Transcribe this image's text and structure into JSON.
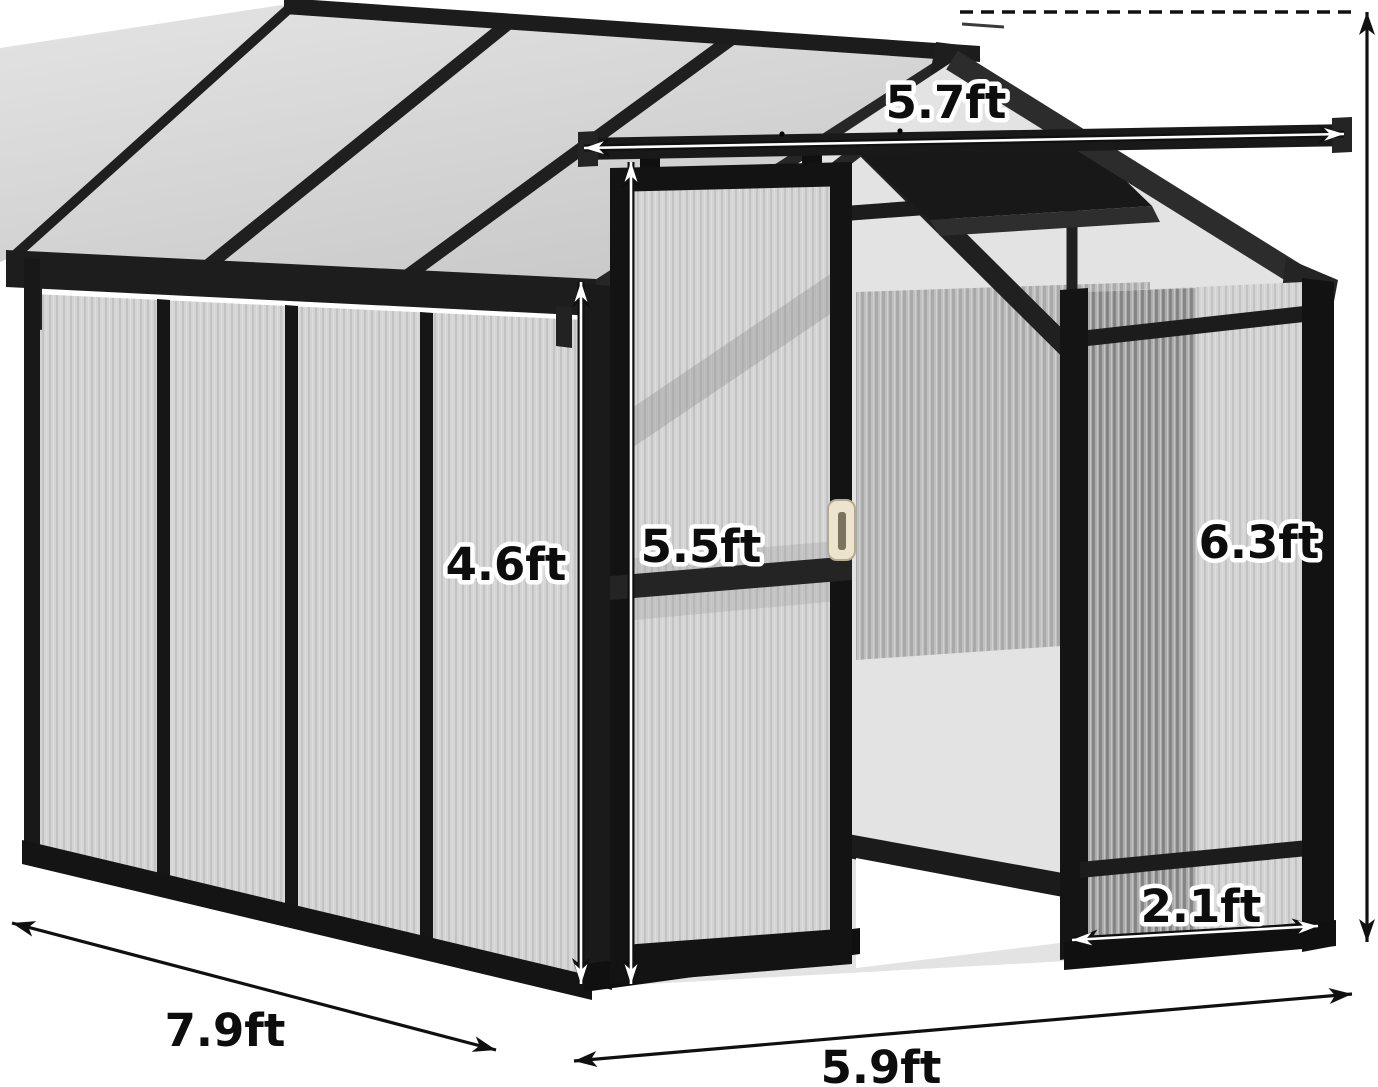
{
  "figure": {
    "kind": "product-dimension-diagram",
    "subject": "greenhouse with sliding door and sliding roof rail",
    "background": "#ffffff",
    "colors": {
      "frame": "#1a1a1a",
      "panel_glass": "#d4d4d4",
      "panel_rib": "#c0c0c0",
      "roof_glass_light": "#e2e2e2",
      "roof_glass_dark": "#cccccc",
      "interior_glass": "#e3e3e3",
      "door_handle": "#ece4cd",
      "dimension_line": "#101010",
      "label_text": "#0d0d0d",
      "label_outline": "#ffffff"
    },
    "dimensions": [
      {
        "id": "top-rail-length",
        "label": "5.7ft"
      },
      {
        "id": "side-wall-height",
        "label": "4.6ft"
      },
      {
        "id": "door-height",
        "label": "5.5ft"
      },
      {
        "id": "peak-height",
        "label": "6.3ft"
      },
      {
        "id": "front-panel-width",
        "label": "2.1ft"
      },
      {
        "id": "side-depth",
        "label": "7.9ft"
      },
      {
        "id": "front-width",
        "label": "5.9ft"
      }
    ]
  }
}
